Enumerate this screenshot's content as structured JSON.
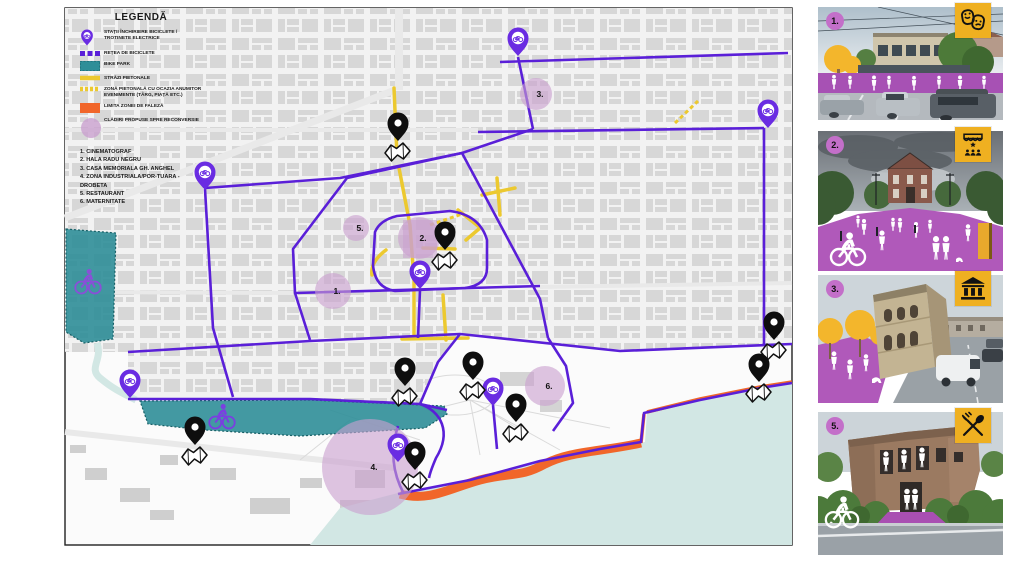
{
  "legend": {
    "title": "LEGENDĂ",
    "items": [
      {
        "icon": "bike-station-pin-icon",
        "label": "STAȚII ÎNCHIRIERE BICICLETE / TROTINETE ELECTRICE"
      },
      {
        "icon": "bike-network-line-icon",
        "label": "REȚEA DE BICICLETE"
      },
      {
        "icon": "bike-park-swatch-icon",
        "label": "BIKE PARK"
      },
      {
        "icon": "pedestrian-street-line-icon",
        "label": "STRĂZI PIETONALE"
      },
      {
        "icon": "event-pedestrian-zone-icon",
        "label": "ZONĂ PIETONALĂ CU OCAZIA ANUMITOR EVENIMENTE (TÂRG, PIAȚĂ ETC.)"
      },
      {
        "icon": "faleza-zone-swatch-icon",
        "label": "LIMITA ZONEI DE FALEZĂ"
      },
      {
        "icon": "reconversion-circle-icon",
        "label": "CLĂDIRI PROPUSE SPRE RECONVERSIE"
      }
    ],
    "numbered_list": [
      "1. CINEMATOGRAF",
      "2. HALA RADU NEGRU",
      "3. CASA MEMORIALA GH. ANGHEL",
      "4. ZONA INDUSTRIALA/POR-TUARA - DROBETA",
      "5. RESTAURANT",
      "6. MATERNITATE"
    ]
  },
  "map": {
    "colors": {
      "bike_route": "#5a1fd8",
      "bike_station_pin": "#6a2ce2",
      "pedestrian_street": "#ecc92f",
      "bike_park": "#2f8e98",
      "faleza_limit": "#f1662a",
      "reconversion": "#c9a0ce",
      "water": "#d2e7e4",
      "poi_pin": "#0e0e0e"
    },
    "bike_station_pins": [
      {
        "x": 205,
        "y": 190
      },
      {
        "x": 518,
        "y": 56
      },
      {
        "x": 768,
        "y": 128
      },
      {
        "x": 130,
        "y": 398
      },
      {
        "x": 420,
        "y": 289
      },
      {
        "x": 493,
        "y": 406
      },
      {
        "x": 398,
        "y": 462
      }
    ],
    "poi_pins": [
      {
        "x": 398,
        "y": 141
      },
      {
        "x": 445,
        "y": 250
      },
      {
        "x": 405,
        "y": 386
      },
      {
        "x": 473,
        "y": 380
      },
      {
        "x": 516,
        "y": 422
      },
      {
        "x": 195,
        "y": 445
      },
      {
        "x": 415,
        "y": 470
      },
      {
        "x": 774,
        "y": 340
      },
      {
        "x": 759,
        "y": 382
      }
    ],
    "reconversion_sites": [
      {
        "label": "1.",
        "x": 333,
        "y": 291,
        "r": 18
      },
      {
        "label": "2.",
        "x": 419,
        "y": 238,
        "r": 21
      },
      {
        "label": "3.",
        "x": 536,
        "y": 94,
        "r": 16
      },
      {
        "label": "4.",
        "x": 370,
        "y": 467,
        "r": 48
      },
      {
        "label": "5.",
        "x": 356,
        "y": 228,
        "r": 13
      },
      {
        "label": "6.",
        "x": 545,
        "y": 386,
        "r": 20
      }
    ]
  },
  "panels": [
    {
      "number": "1.",
      "icon": "theater-masks-icon"
    },
    {
      "number": "2.",
      "icon": "market-stall-icon"
    },
    {
      "number": "3.",
      "icon": "museum-icon"
    },
    {
      "number": "5.",
      "icon": "fork-spoon-icon"
    }
  ]
}
